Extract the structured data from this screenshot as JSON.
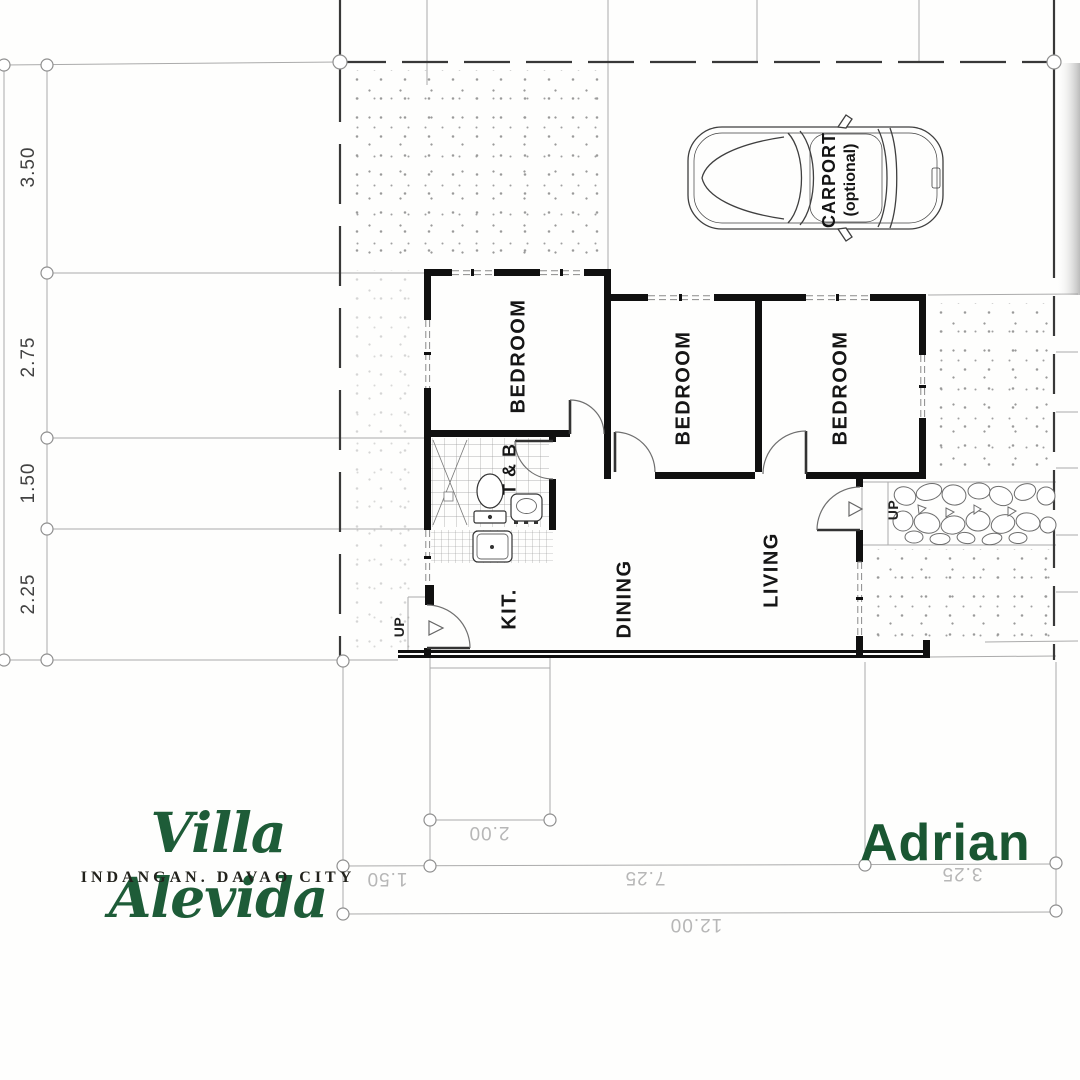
{
  "branding": {
    "logo_script": "Villa Alevida",
    "logo_subtitle": "INDANGAN. DAVAO CITY",
    "model_name": "Adrian",
    "brand_green": "#1E5C38",
    "model_green": "#1A5632"
  },
  "rooms": {
    "bedroom": "BEDROOM",
    "toilet_bath": "T & B",
    "kitchen": "KIT.",
    "dining": "DINING",
    "living": "LIVING",
    "carport": "CARPORT",
    "carport_note": "(optional)",
    "up": "UP"
  },
  "dimensions": {
    "left": [
      "3.50",
      "2.75",
      "1.50",
      "2.25"
    ],
    "bottom_upper": "2.00",
    "bottom_row": [
      "1.50",
      "7.25",
      "3.25"
    ],
    "bottom_total": "12.00",
    "units": "meters"
  }
}
